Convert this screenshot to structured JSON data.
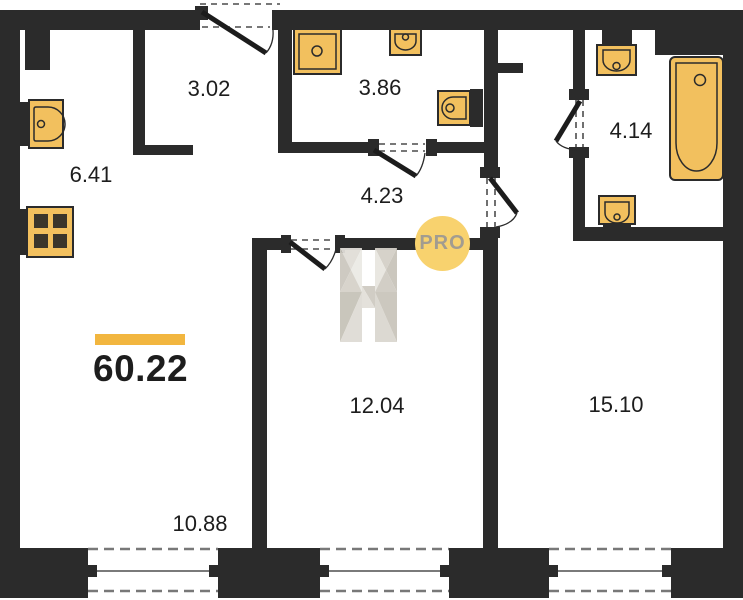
{
  "summary": {
    "total_area": "60.22"
  },
  "rooms": {
    "entry_hall": {
      "area": "3.02"
    },
    "bathroom_small": {
      "area": "3.86"
    },
    "corridor": {
      "area": "4.23"
    },
    "kitchen": {
      "area": "6.41"
    },
    "bathroom_large": {
      "area": "4.14"
    },
    "living_room": {
      "area": "10.88"
    },
    "bedroom_mid": {
      "area": "12.04"
    },
    "bedroom_large": {
      "area": "15.10"
    }
  },
  "watermark": {
    "monogram": "H",
    "badge": "PRO"
  },
  "colors": {
    "wall": "#2b2b2b",
    "fixture_fill": "#f2c05e",
    "accent_bar": "#f2b63f",
    "badge_fill": "#f8d26e",
    "badge_text": "#a29c90"
  },
  "fixtures": [
    "kitchen-sink",
    "stove",
    "shower",
    "washbasin",
    "toilet",
    "bathtub"
  ]
}
